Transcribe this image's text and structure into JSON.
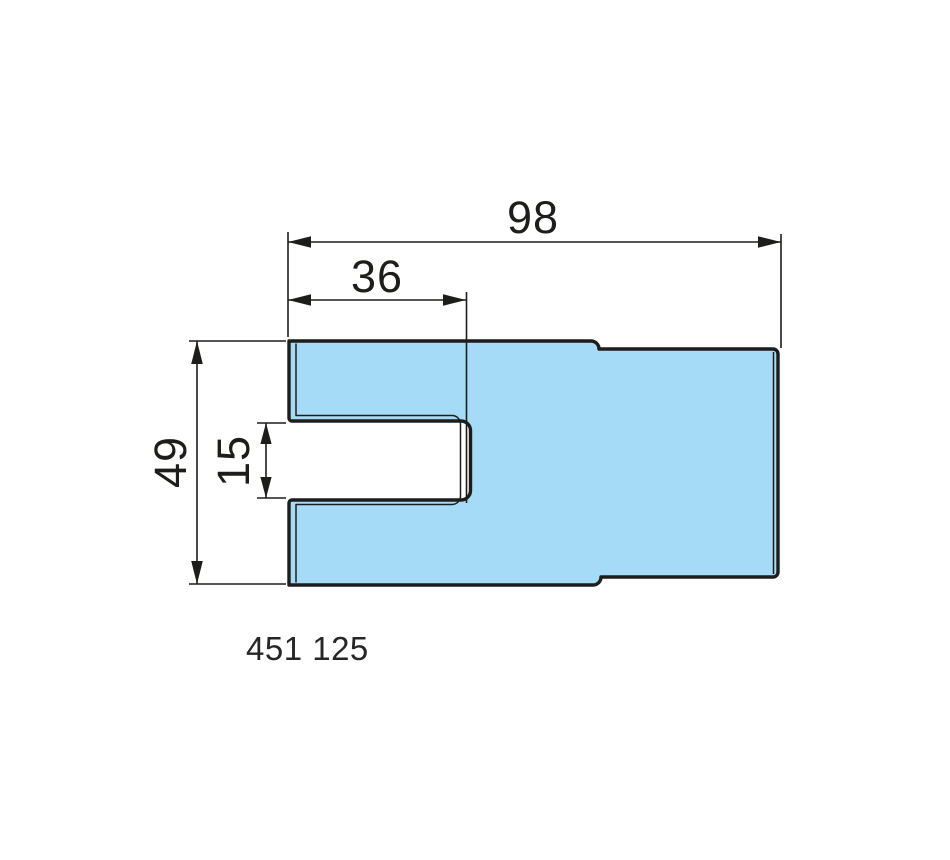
{
  "colors": {
    "part_fill": "#A6DBF8",
    "line_color": "#1D1D1B"
  },
  "part": {
    "number": "451 125"
  },
  "dimensions": {
    "overall_width": {
      "value": "98"
    },
    "slot_depth": {
      "value": "36"
    },
    "overall_height": {
      "value": "49"
    },
    "slot_opening": {
      "value": "15"
    }
  }
}
